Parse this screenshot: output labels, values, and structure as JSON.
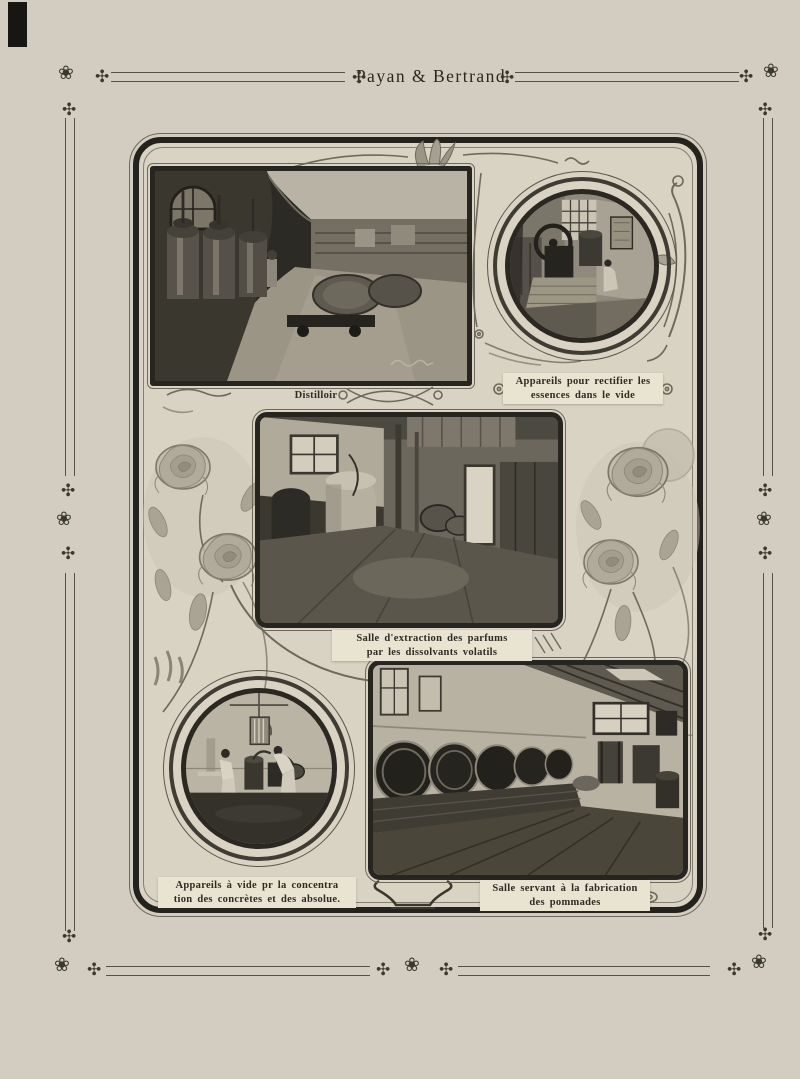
{
  "page": {
    "title": "Payan & Bertrand"
  },
  "ornaments": {
    "star": "✣",
    "rose": "❀"
  },
  "figures": {
    "distilloir": {
      "lines": [
        "Distilloir",
        ""
      ]
    },
    "rectifier": {
      "lines": [
        "Appareils pour rectifier les",
        "essences dans le vide"
      ]
    },
    "extraction": {
      "lines": [
        "Salle d'extraction des parfums",
        "par les dissolvants volatils"
      ]
    },
    "concentration": {
      "lines": [
        "Appareils à vide pr la concentra",
        "tion des concrètes et des absolue."
      ]
    },
    "pommades": {
      "lines": [
        "Salle servant à la fabrication",
        "des pommades"
      ]
    }
  },
  "colors": {
    "page_bg": "#d2cdc0",
    "panel_bg": "#d9d3c4",
    "ink": "#2e2b23",
    "caption_strip": "#e9e3d1",
    "frame_border": "#24221c"
  }
}
